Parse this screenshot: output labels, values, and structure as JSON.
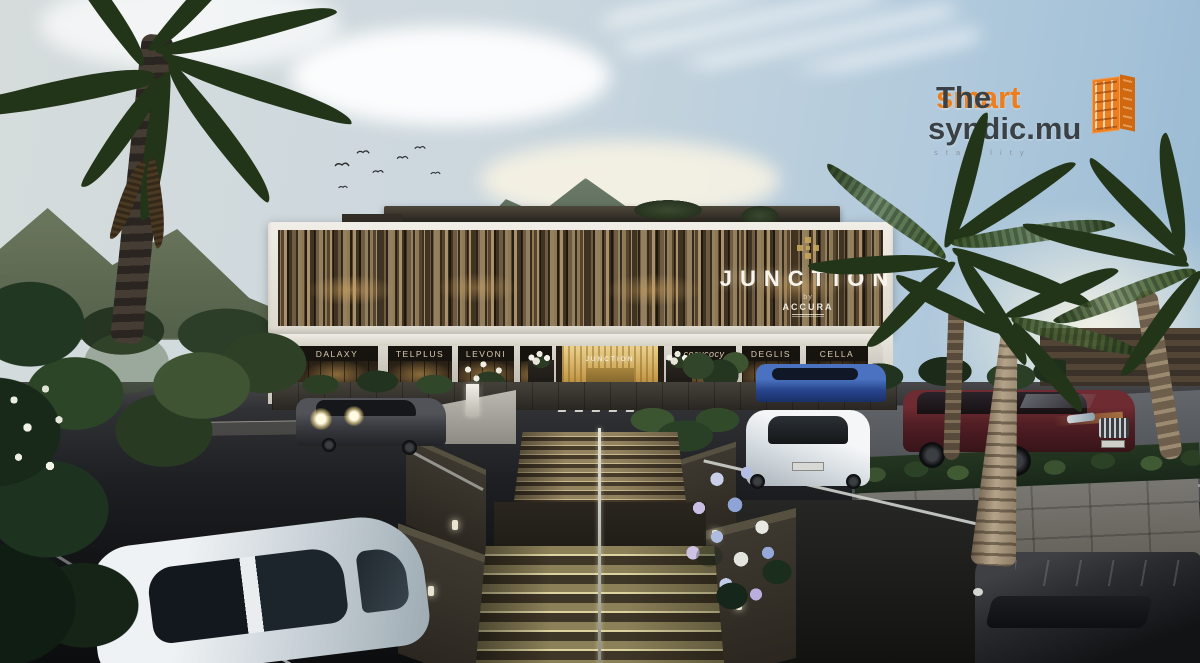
{
  "watermark": {
    "brand_word1": "The ",
    "brand_word2": "smart",
    "brand_line2": "syndic.mu",
    "tagline_fragment": "s t a b i l i t y",
    "accent_color": "#ee7d1b",
    "text_color": "#3a4146"
  },
  "building": {
    "main_sign": "JUNCTION",
    "byline": "by",
    "developer": "ACCURA",
    "entrance_sign": "JUNCTION",
    "shop_signs": [
      {
        "label": "DALAXY"
      },
      {
        "label": "TELPLUS"
      },
      {
        "label": "LEVONI"
      },
      {
        "label": "cocycocy"
      },
      {
        "label": "DEGLIS"
      },
      {
        "label": "CELLA"
      }
    ],
    "facade_colors": {
      "frame_white": "#f1eee7",
      "slat_brown_light": "#a9906a",
      "slat_brown_dark": "#3f3322",
      "entrance_gold": "#c79d4c",
      "sign_text": "#f7f4ec"
    }
  },
  "scene": {
    "sky_top_right": "#96b9d3",
    "sky_haze": "#faf2d8",
    "mountain_green": "#5e6e5c",
    "asphalt_dark": "#121315",
    "stone_wall_gray": "#7b7974",
    "vehicle_colors": {
      "suv_left_gray": "#393b40",
      "hatchback_white": "#f4f6f8",
      "car_blue": "#3a5fa8",
      "suv_maroon": "#511e24",
      "suv_dark_right": "#292b2e",
      "foreground_car_white": "#eff2f4"
    }
  }
}
